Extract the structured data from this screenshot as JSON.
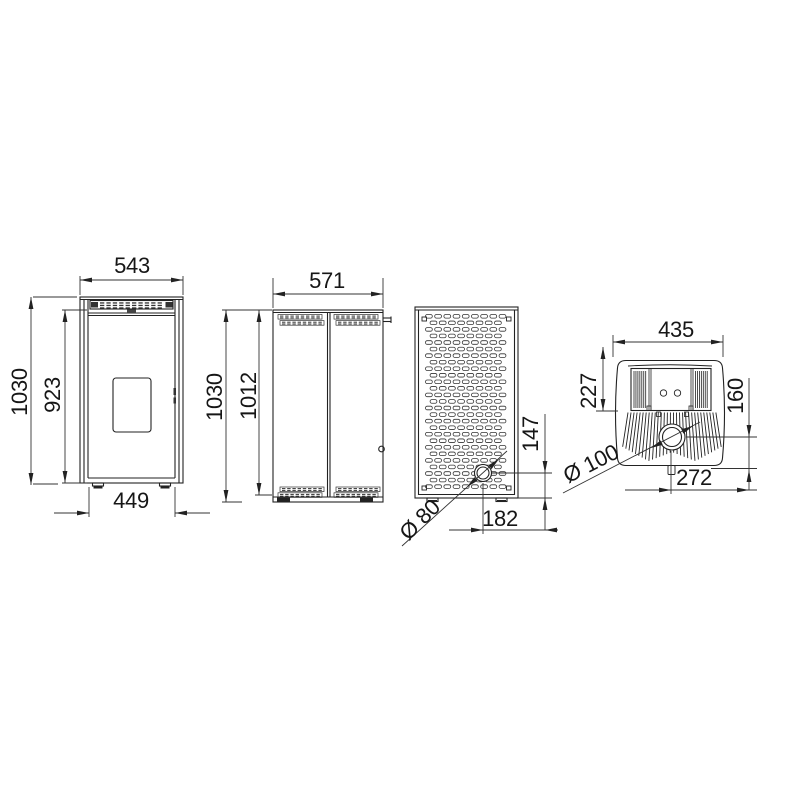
{
  "drawing": {
    "type": "technical-dimension-drawing",
    "subject": "pellet stove orthographic views",
    "line_color": "#222222",
    "background": "#ffffff"
  },
  "dimensions": {
    "front_view": {
      "overall_width": "543",
      "overall_height": "1030",
      "door_height": "923",
      "base_width": "449"
    },
    "side_view": {
      "overall_depth": "571",
      "overall_height": "1030",
      "panel_height": "1012"
    },
    "rear_view": {
      "flue_height": "147",
      "flue_diameter": "Ø 80",
      "flue_offset": "182"
    },
    "top_view": {
      "overall_width": "435",
      "rear_section_depth": "227",
      "flue_to_rear": "160",
      "flue_diameter": "Ø 100",
      "flue_offset": "272"
    }
  }
}
